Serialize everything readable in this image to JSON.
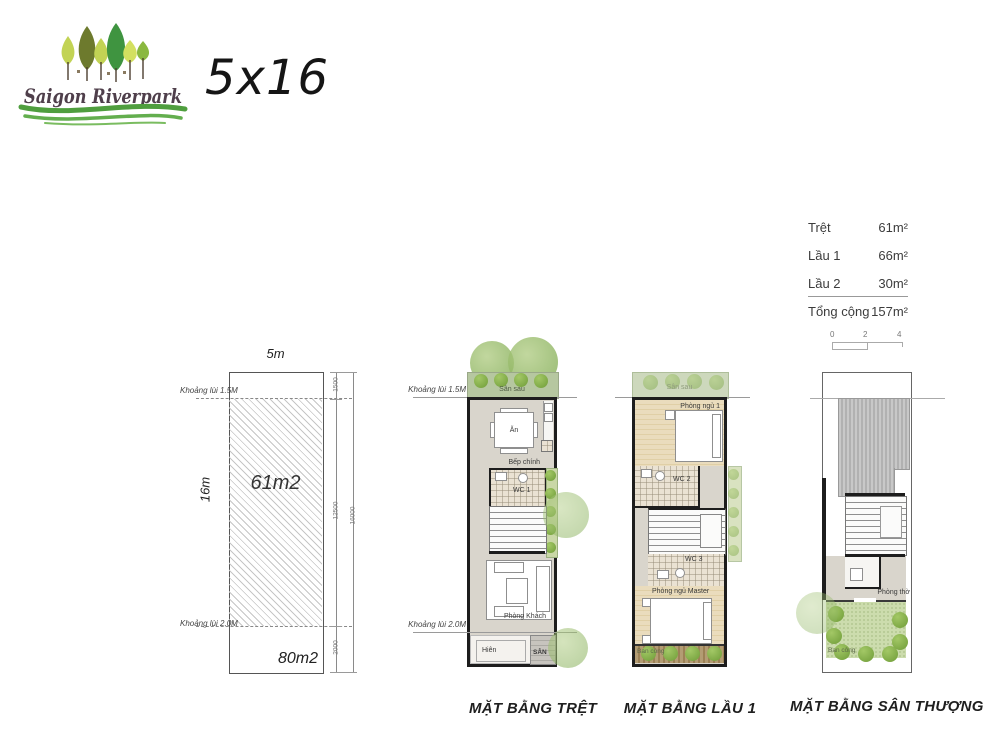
{
  "header": {
    "brand": "Saigon Riverpark",
    "size_label": "5x16"
  },
  "summary": {
    "rows": [
      {
        "label": "Trệt",
        "value": "61m²"
      },
      {
        "label": "Lầu 1",
        "value": "66m²"
      },
      {
        "label": "Lầu 2",
        "value": "30m²"
      }
    ],
    "total": {
      "label": "Tổng cộng",
      "value": "157m²"
    },
    "scale": {
      "t0": "0",
      "t1": "2",
      "t2": "4"
    }
  },
  "lot": {
    "width": "5m",
    "depth": "16m",
    "build_area": "61m2",
    "lot_area": "80m2",
    "setback_top": "Khoảng lùi 1.5M",
    "setback_bottom": "Khoảng lùi 2.0M",
    "dim_top": "1500",
    "dim_mid": "12500",
    "dim_bottom": "2000",
    "dim_total": "16000"
  },
  "ground": {
    "title": "MẶT BẰNG TRỆT",
    "setback_top": "Khoảng lùi 1.5M",
    "setback_bottom": "Khoảng lùi 2.0M",
    "backyard": "Sân sau",
    "dining": "Ăn",
    "kitchen": "Bếp chính",
    "wc": "WC 1",
    "living": "Phòng Khách",
    "porch": "Hiên",
    "yard": "SÂN"
  },
  "first": {
    "title": "MẶT BẰNG LẦU 1",
    "backyard": "Sân sau",
    "bedroom1": "Phòng ngủ 1",
    "wc2": "WC 2",
    "wc3": "WC 3",
    "master": "Phòng ngủ Master",
    "balcony": "Ban công"
  },
  "roof": {
    "title": "MẶT BẰNG SÂN THƯỢNG",
    "worship": "Phòng thờ",
    "balcony": "Ban công"
  },
  "colors": {
    "wall": "#1d1d1d",
    "floor_gray": "#d9d5cc",
    "backyard_green": "#b6c7a0",
    "shrub_green": "#6f9c38",
    "garden_green": "#ccdcad",
    "wood": "#e5d4ae",
    "deck_wood": "#a98f62",
    "roof_gray": "#bcbcbc",
    "logo_text": "#4f3f4b",
    "swoosh_green": "#4f9e3e"
  }
}
